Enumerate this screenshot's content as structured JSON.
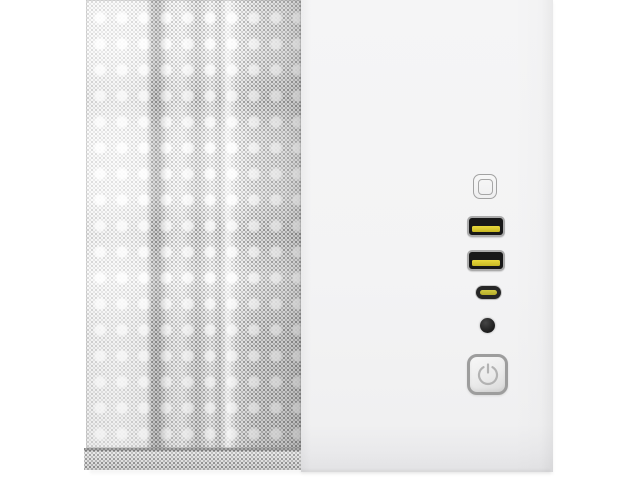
{
  "scene": {
    "description": "Product photo of a white mini-tower PC case: perforated mesh front panel on the left, smooth white panel with front I/O column on the right, on a white background",
    "background_color": "#ffffff",
    "case_colors": {
      "mesh_base": "#efefef",
      "mesh_perforation": "#6b6b6b",
      "face_panel": "#f3f3f4",
      "usb_tongue_yellow": "#d9c832",
      "usb_c_slot_yellow": "#c9c33a",
      "audio_jack_black": "#232323",
      "power_button_border": "#9d9d9d",
      "power_symbol_gray": "#b3b3b3"
    },
    "panels": {
      "mesh_panel": {
        "label": "perforated mesh front panel"
      },
      "mesh_bottom_strip": {
        "label": "mesh panel bottom strip below seam"
      },
      "face_panel": {
        "label": "smooth white panel with front I/O"
      }
    },
    "io": {
      "led_button": {
        "label": "LED control button (rounded square)"
      },
      "usb_a_top": {
        "label": "USB Type-A port, top, yellow tongue"
      },
      "usb_a_bottom": {
        "label": "USB Type-A port, bottom, yellow tongue"
      },
      "usb_c": {
        "label": "USB Type-C port"
      },
      "audio_jack": {
        "label": "3.5mm audio jack"
      },
      "power_button": {
        "label": "Power button with power symbol"
      }
    }
  }
}
